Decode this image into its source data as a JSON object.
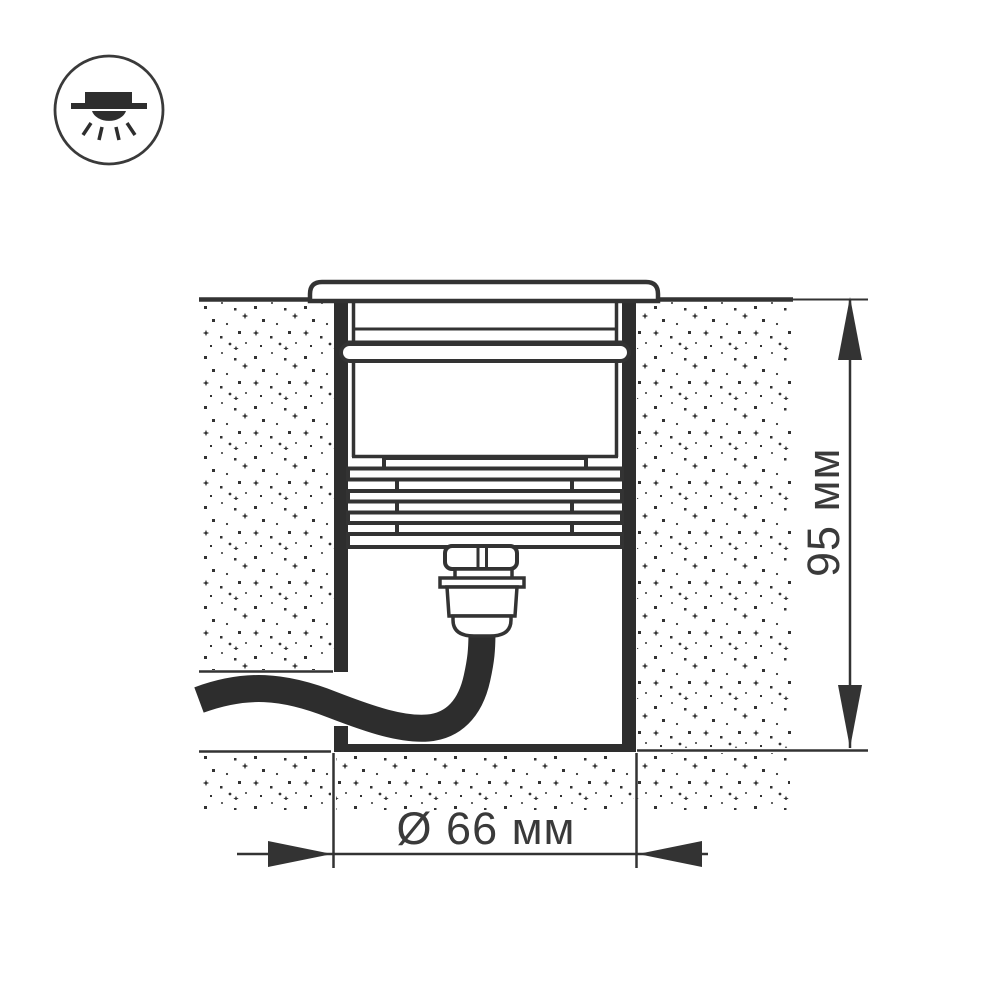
{
  "icon": {
    "name": "recessed-downlight-icon"
  },
  "diagram": {
    "kind": "in-ground recessed luminaire installation cross-section",
    "dimensions": {
      "height": "95 мм",
      "diameter": "Ø 66 мм"
    }
  },
  "colors": {
    "line": "#333333",
    "fill_dark": "#2e2e2e",
    "background": "#ffffff",
    "text": "#3a3a3a"
  }
}
